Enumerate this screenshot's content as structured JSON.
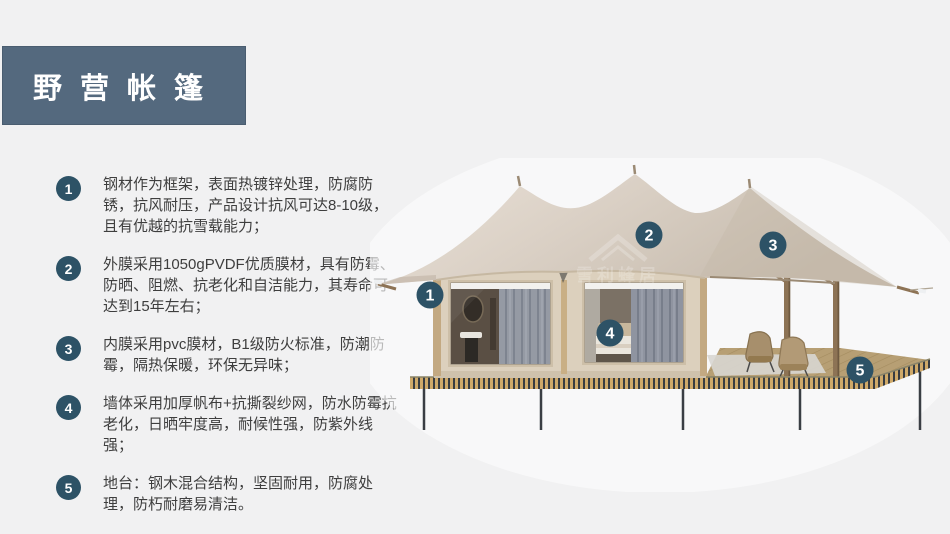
{
  "header": {
    "title": "野营帐篷"
  },
  "features": [
    {
      "num": "1",
      "text": "钢材作为框架，表面热镀锌处理，防腐防锈，抗风耐压，产品设计抗风可达8-10级，且有优越的抗雪载能力；"
    },
    {
      "num": "2",
      "text": "外膜采用1050gPVDF优质膜材，具有防霉、防晒、阻燃、抗老化和自洁能力，其寿命可达到15年左右；"
    },
    {
      "num": "3",
      "text": "内膜采用pvc膜材，B1级防火标准，防潮防霉，隔热保暖，环保无异味；"
    },
    {
      "num": "4",
      "text": "墙体采用加厚帆布+抗撕裂纱网，防水防霉抗老化，日晒牢度高，耐候性强，防紫外线强；"
    },
    {
      "num": "5",
      "text": "地台：钢木混合结构，坚固耐用，防腐处理，防朽耐磨易清洁。"
    }
  ],
  "diagram": {
    "markers": [
      {
        "num": "1"
      },
      {
        "num": "2"
      },
      {
        "num": "3"
      },
      {
        "num": "4"
      },
      {
        "num": "5"
      }
    ],
    "watermark_text": "雪利蜂居"
  },
  "colors": {
    "page_bg": "#f1f1f2",
    "header_bg": "#54697e",
    "badge": "#2d5266",
    "roof_fabric": "#d8cec3",
    "wall": "#dcd0bd",
    "deck_stripe_light": "#cfa969",
    "deck_stripe_dark": "#383c41"
  }
}
